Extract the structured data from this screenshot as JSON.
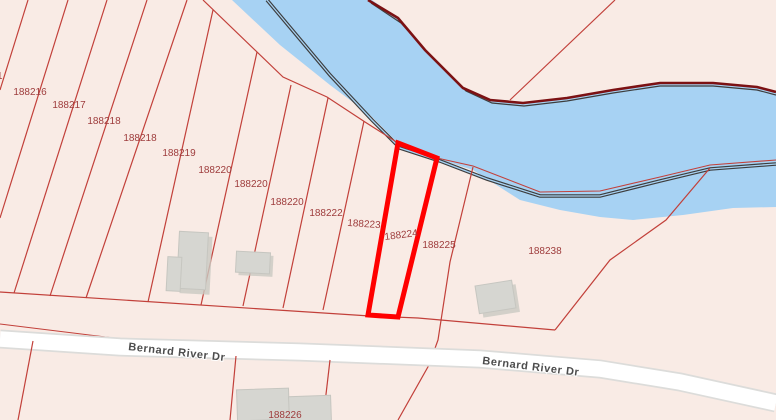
{
  "map": {
    "description": "Cadastral parcel map with river and road, one parcel highlighted",
    "highlighted_parcel": "188224",
    "road": {
      "name": "Bernard River Dr"
    },
    "river": {
      "name": ""
    },
    "parcel_labels": [
      {
        "label": "1"
      },
      {
        "label": "188216"
      },
      {
        "label": "188217"
      },
      {
        "label": "188218"
      },
      {
        "label": "188218"
      },
      {
        "label": "188219"
      },
      {
        "label": "188220"
      },
      {
        "label": "188220"
      },
      {
        "label": "188220"
      },
      {
        "label": "188222"
      },
      {
        "label": "188223"
      },
      {
        "label": "188224"
      },
      {
        "label": "188225"
      },
      {
        "label": "188238"
      },
      {
        "label": "188226"
      }
    ],
    "road_labels": [
      {
        "label": "Bernard River Dr"
      },
      {
        "label": "Bernard River Dr"
      }
    ]
  },
  "colors": {
    "land": "#f9ebe5",
    "water": "#a7d2f3",
    "parcel_line": "#c2403a",
    "parcel_label": "#9e3c3c",
    "highlight": "#ff0000",
    "dark_bank": "#7c1113",
    "channel": "#3d3d3d",
    "road_casing": "#dcdcda",
    "road_fill": "#ffffff",
    "road_label": "#4c4c4c",
    "building": "#d6d6d1",
    "building_border": "#c6c6c0",
    "building_shadow": "#c9c9c2"
  }
}
